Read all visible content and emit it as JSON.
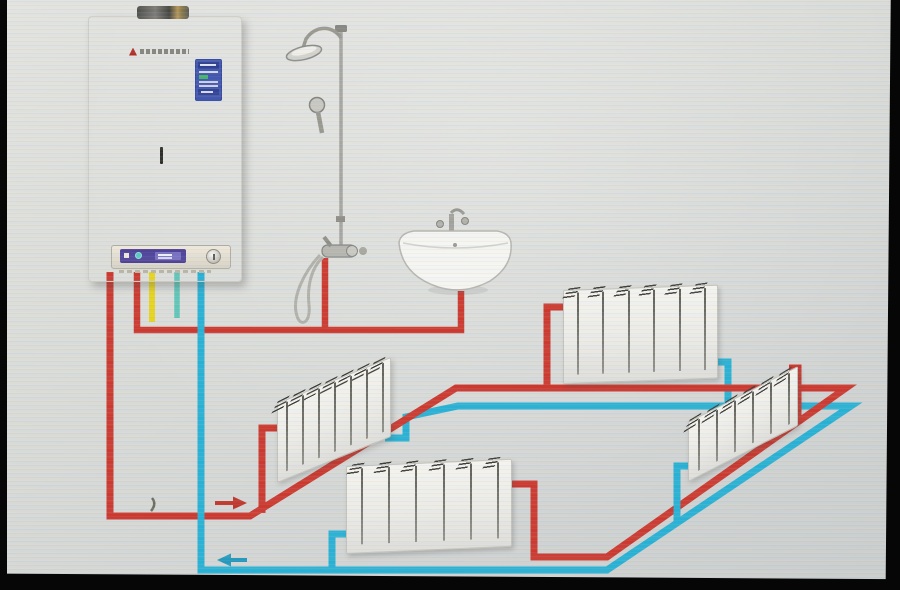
{
  "scene": {
    "kind": "boiler-heating-system-piping-diagram",
    "description": "Wall-hung gas boiler supplying a shower set, a wall washbasin and four radiators through red supply and blue return piping around a room",
    "background_color": "#d8dad6",
    "frame_color": "#060606"
  },
  "boiler": {
    "title": "Wall-hung gas boiler",
    "body_color": "#f5f5f2",
    "energy_label_color": "#4156ae",
    "lcd_color": "#4e4399",
    "knob": "control-knob"
  },
  "fixtures": {
    "shower": {
      "title": "Shower column with rain head, hand shower and mixer valve"
    },
    "basin": {
      "title": "Wall-hung washbasin with faucet"
    }
  },
  "pipes": {
    "supply": {
      "color": "#cb392f",
      "flow_direction": "right"
    },
    "return": {
      "color": "#28b1d4",
      "flow_direction": "left"
    },
    "gas": {
      "color": "#e6d41f"
    },
    "aux": {
      "color": "#49c2b2"
    },
    "domestic_hot_water": {
      "color": "#cb392f",
      "serves": [
        "shower",
        "basin"
      ]
    }
  },
  "radiators": [
    {
      "id": "mid-left-radiator",
      "title": "Radiator (left wall)",
      "sections": 7
    },
    {
      "id": "top-right-radiator",
      "title": "Radiator (far wall)",
      "sections": 6
    },
    {
      "id": "right-wall-radiator",
      "title": "Radiator (right wall)",
      "sections": 6
    },
    {
      "id": "bottom-middle-radiator",
      "title": "Radiator (front)",
      "sections": 6
    }
  ],
  "arrows": [
    {
      "name": "supply-flow-arrow",
      "direction": "right",
      "color": "#bf362c"
    },
    {
      "name": "return-flow-arrow",
      "direction": "left",
      "color": "#2499bd"
    }
  ]
}
